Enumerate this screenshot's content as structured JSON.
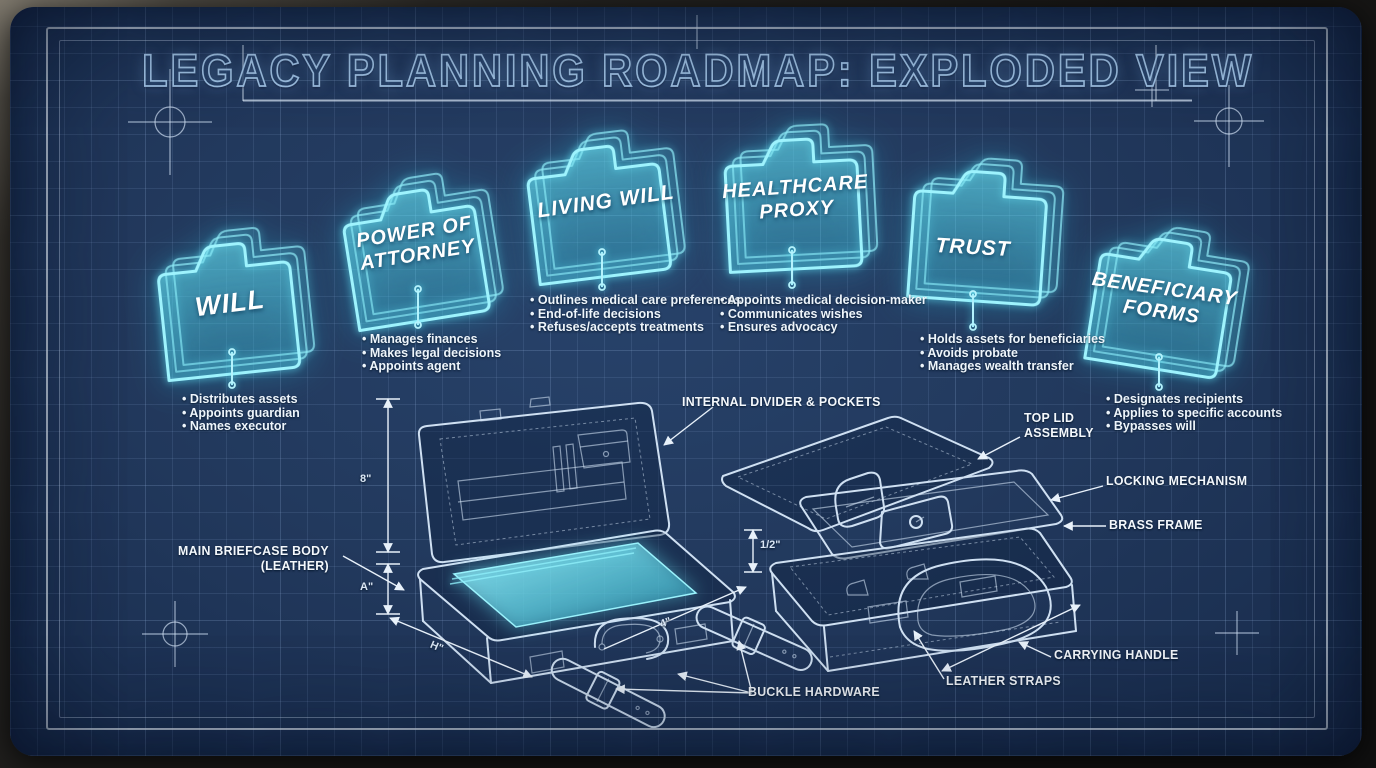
{
  "title": "LEGACY PLANNING ROADMAP: EXPLODED VIEW",
  "folders": [
    {
      "label": "WILL",
      "bullets": [
        "• Distributes assets",
        "• Appoints guardian",
        "• Names executor"
      ]
    },
    {
      "label": "POWER OF\nATTORNEY",
      "bullets": [
        "• Manages finances",
        "• Makes legal decisions",
        "• Appoints agent"
      ]
    },
    {
      "label": "LIVING WILL",
      "bullets": [
        "• Outlines medical care preferences",
        "• End-of-life decisions",
        "• Refuses/accepts treatments"
      ]
    },
    {
      "label": "HEALTHCARE\nPROXY",
      "bullets": [
        "• Appoints medical decision-maker",
        "• Communicates wishes",
        "• Ensures advocacy"
      ]
    },
    {
      "label": "TRUST",
      "bullets": [
        "• Holds assets for beneficiaries",
        "• Avoids probate",
        "• Manages wealth transfer"
      ]
    },
    {
      "label": "BENEFICIARY\nFORMS",
      "bullets": [
        "• Designates recipients",
        "• Applies to specific accounts",
        "• Bypasses will"
      ]
    }
  ],
  "part_labels": {
    "internal_divider": "INTERNAL DIVIDER & POCKETS",
    "top_lid": "TOP LID\nASSEMBLY",
    "locking_mechanism": "LOCKING MECHANISM",
    "brass_frame": "BRASS FRAME",
    "main_body": "MAIN BRIEFCASE BODY\n(LEATHER)",
    "carrying_handle": "CARRYING HANDLE",
    "leather_straps": "LEATHER STRAPS",
    "buckle_hardware": "BUCKLE HARDWARE"
  },
  "dimensions": {
    "lid_height": "8\"",
    "body_depth": "A\"",
    "body_width": "H\"",
    "strap_length": "4\"",
    "frame_gap": "1/2\""
  },
  "colors": {
    "blueprint_bg": "#1d3357",
    "grid_line": "#8caad7",
    "folder_glow": "#7deef8",
    "line_art": "#cfe0f2",
    "label_text": "#f4f8fc"
  }
}
